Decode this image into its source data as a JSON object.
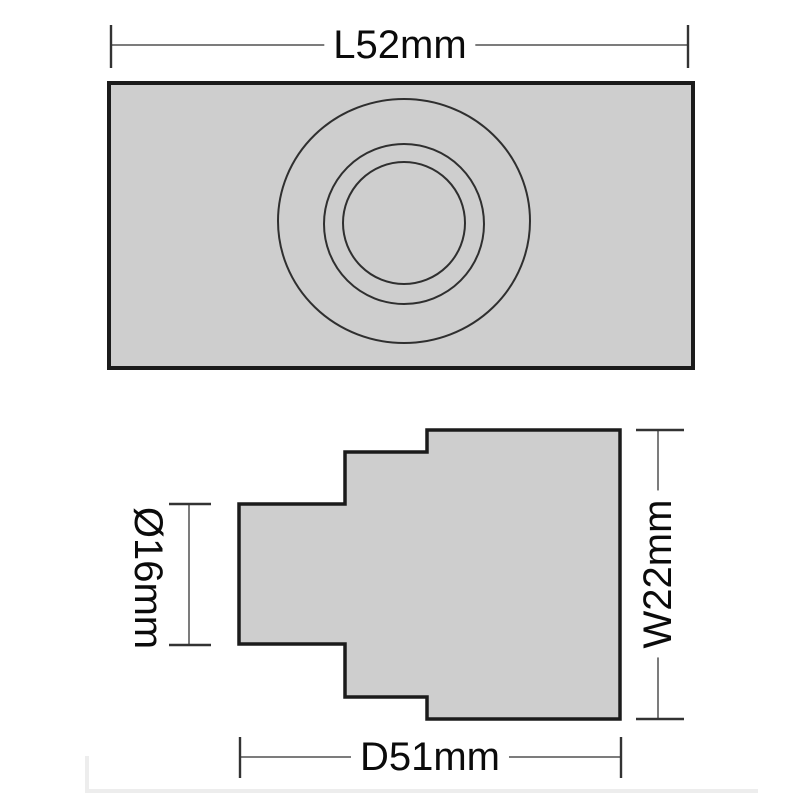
{
  "dimensions": {
    "length": {
      "label": "L52mm",
      "orientation": "horizontal",
      "position": "top"
    },
    "diameter": {
      "label": "Ø16mm",
      "orientation": "vertical",
      "position": "left"
    },
    "width": {
      "label": "W22mm",
      "orientation": "vertical",
      "position": "right"
    },
    "depth": {
      "label": "D51mm",
      "orientation": "horizontal",
      "position": "bottom"
    }
  },
  "colors": {
    "background": "#ffffff",
    "shape_fill": "#cecece",
    "shape_outline": "#1b1b1b",
    "circle_stroke": "#2f2f2f",
    "dimension_line": "#505050",
    "dimension_tick": "#333333",
    "label_text": "#0b0b0b",
    "faint_frame": "#ededed"
  }
}
